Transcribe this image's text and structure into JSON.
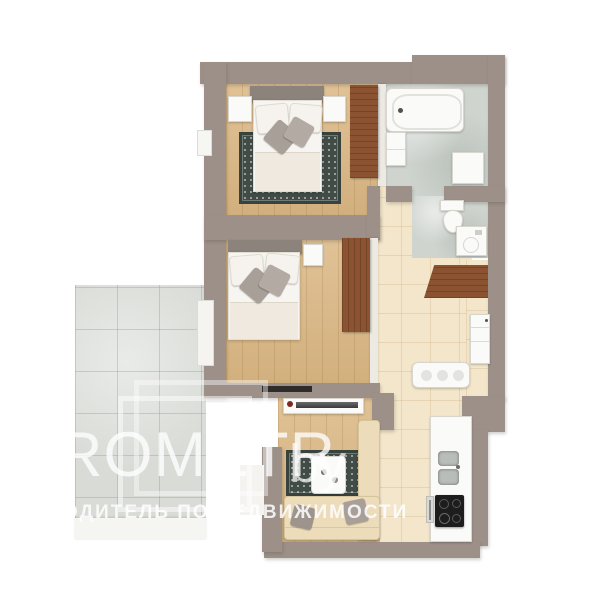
{
  "watermark": {
    "brand": "PROMETR",
    "brand_suffix": "by",
    "tagline_prefix": "ПУТЕ",
    "tagline": "ВОДИТЕЛЬ ПО НЕДВИЖИМОСТИ"
  },
  "palette": {
    "background": "#ffffff",
    "wall": "#9c9089",
    "wood_floor": "#dcba88",
    "hall_tile": "#f3e6cb",
    "bathroom_marble": "#cfd4cf",
    "balcony_tile": "#d8dbd6",
    "wardrobe_wood": "#8b5331",
    "rug": "#414c46",
    "sofa": "#ecdcba",
    "fixtures_white": "#fafaf8",
    "cooktop_black": "#1d1d1d",
    "watermark_white": "#ffffff"
  }
}
